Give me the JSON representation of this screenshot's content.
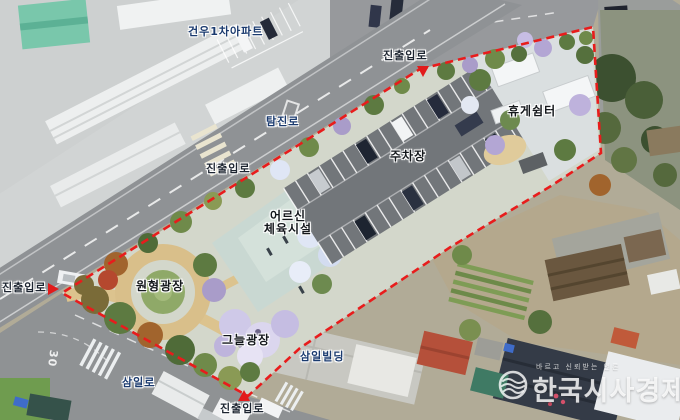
{
  "labels": {
    "apartment": "건우1차아파트",
    "road_tamjin": "탐진로",
    "road_samil": "삼일로",
    "building_samil": "삼일빌딩",
    "entrance_top": "진출입로",
    "entrance_mid": "진출입로",
    "entrance_left": "진출입로",
    "entrance_bottom": "진출입로",
    "parking": "주차장",
    "rest_shelter": "휴게쉼터",
    "senior_line1": "어르신",
    "senior_line2": "체육시설",
    "circle_plaza": "원형광장",
    "shade_plaza": "그늘광장",
    "road_marking_30": "30"
  },
  "watermark": {
    "name": "한국시사경제",
    "tagline": "바르고 신뢰받는 언론"
  },
  "colors": {
    "site_boundary": "#e81c1c",
    "entrance_arrow": "#e21b1b",
    "parking_asphalt": "#72767a",
    "plaza_sand": "#d9bf8a",
    "label_navy": "#1a3a6e"
  }
}
